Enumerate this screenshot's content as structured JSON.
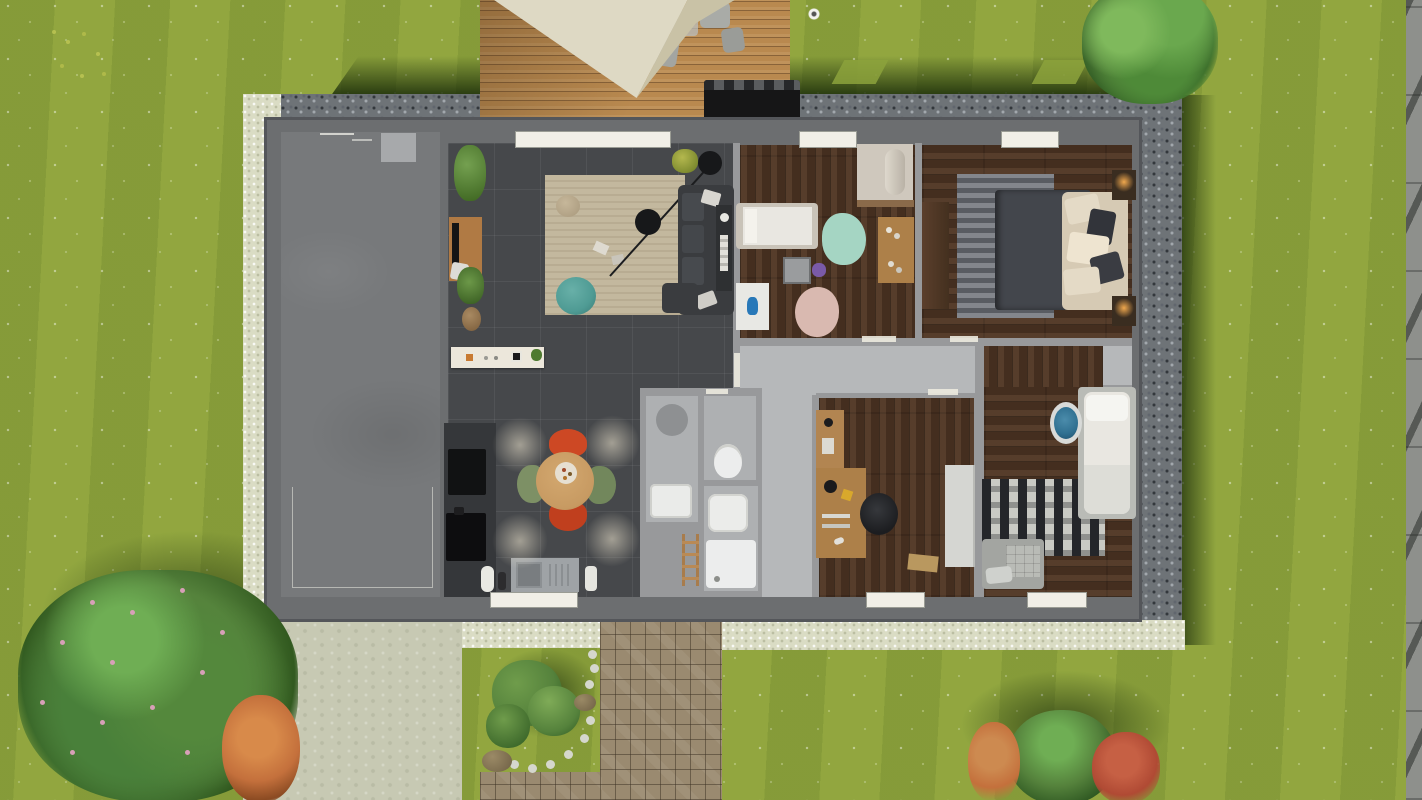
{
  "app": {
    "name": "3D floor plan — top-down render",
    "view": "bird's-eye view of single-storey house with garden",
    "visible_text": []
  },
  "palette": {
    "grass": "#8ca23c",
    "gravel": "#6e7377",
    "pebble": "#dadcc4",
    "driveway": "#c7c9b3",
    "cobble": "#9a8a70",
    "deck_wood": "#b9894f",
    "parasol": "#ded9c4",
    "wall": "#6c6e70",
    "wall_inner": "#98999b",
    "garage_floor": "#77797b",
    "tile_floor": "#46484b",
    "hall_floor": "#b6b8ba",
    "bath_floor": "#aeb0b2",
    "wood_floor": "#4c3322",
    "rug_beige": "#c3b89e",
    "rug_teal": "#a5d5c3",
    "rug_pink": "#d9b9b0",
    "rug_chevron_light": "#83868c",
    "rug_chevron_dark": "#595c62",
    "rug_bw_dark": "#24262a",
    "rug_bw_light": "#c9cac4",
    "sofa": "#3a3c3f",
    "pouf_teal": "#4f9b94",
    "table_wood": "#c79a62",
    "chair_red": "#cd4824",
    "chair_green": "#7d9065",
    "desk_wood": "#ad8049",
    "bed_white": "#e9e7e1",
    "duvet": "#43464c",
    "pillow_beige": "#d6cab4",
    "cabinet_white": "#d5d6d2",
    "window": "#f1efe7",
    "fence": "#8e908c",
    "hedge_shadow": "#1d3a10",
    "bush_green": "#55823c",
    "bush_dark": "#2f5a22",
    "flower_pink": "#d8a0b8",
    "bush_orange": "#c4703c",
    "bush_red": "#b04a34",
    "stone": "#d5d7cd",
    "lamp_glow": "#f0a84e",
    "chair_blue": "#2f6f90",
    "appliance_black": "#111213",
    "grill_black": "#161617"
  },
  "rooms": [
    {
      "name": "garage",
      "floor": "concrete"
    },
    {
      "name": "living-room",
      "floor": "dark tile"
    },
    {
      "name": "kitchen-dining",
      "floor": "dark tile"
    },
    {
      "name": "kids-bedroom",
      "floor": "dark wood"
    },
    {
      "name": "master-bedroom",
      "floor": "dark wood"
    },
    {
      "name": "hallway",
      "floor": "light concrete"
    },
    {
      "name": "shower-room",
      "floor": "gray tile"
    },
    {
      "name": "wc",
      "floor": "gray tile"
    },
    {
      "name": "bathroom",
      "floor": "gray tile"
    },
    {
      "name": "office",
      "floor": "dark wood"
    },
    {
      "name": "bedroom-3",
      "floor": "dark wood"
    },
    {
      "name": "closet",
      "floor": "light concrete"
    }
  ],
  "furniture": {
    "living_room": [
      "area rug",
      "L-sofa with cushions",
      "arc floor lamp",
      "tv console with tv",
      "teal pouf",
      "beige pouf",
      "potted plants",
      "basket"
    ],
    "kitchen": [
      "fridge",
      "oven",
      "wall shelf with jars",
      "sink unit",
      "counter",
      "round dining table",
      "2 red chairs",
      "2 green chairs",
      "ceiling spot lights"
    ],
    "kids_bedroom": [
      "single bed",
      "wardrobe with rolled duvet",
      "desk",
      "play table",
      "purple toy",
      "teal rug",
      "pink rug",
      "white mat with blue vase"
    ],
    "master_bedroom": [
      "double bed with dark duvet and beige pillows",
      "chevron rug",
      "wardrobe",
      "2 nightstands with lit lamps"
    ],
    "bathroom": [
      "walk-in shower",
      "toilet",
      "washbasin",
      "square basin",
      "shower tray",
      "wooden towel ladder"
    ],
    "office": [
      "L-shaped desk",
      "monitor",
      "desk lamp",
      "office chair",
      "white cabinet",
      "door mat"
    ],
    "bedroom_3": [
      "single bed",
      "blue round chair",
      "black-white wave rug",
      "gray bench"
    ]
  },
  "garden": {
    "deck": [
      "wooden terrace",
      "cream parasol",
      "outdoor chairs",
      "black grill"
    ],
    "paths": [
      "pale gravel apron",
      "cobblestone walkway",
      "concrete driveway"
    ],
    "plants": [
      "pink flowering tree bottom-left",
      "orange bush",
      "red bush",
      "green bushes bottom-right",
      "rock garden with white stones",
      "tree top-right",
      "white flower",
      "yellow flowers"
    ],
    "boundary": [
      "gray fence right edge",
      "dark gravel drainage strip around house"
    ]
  }
}
